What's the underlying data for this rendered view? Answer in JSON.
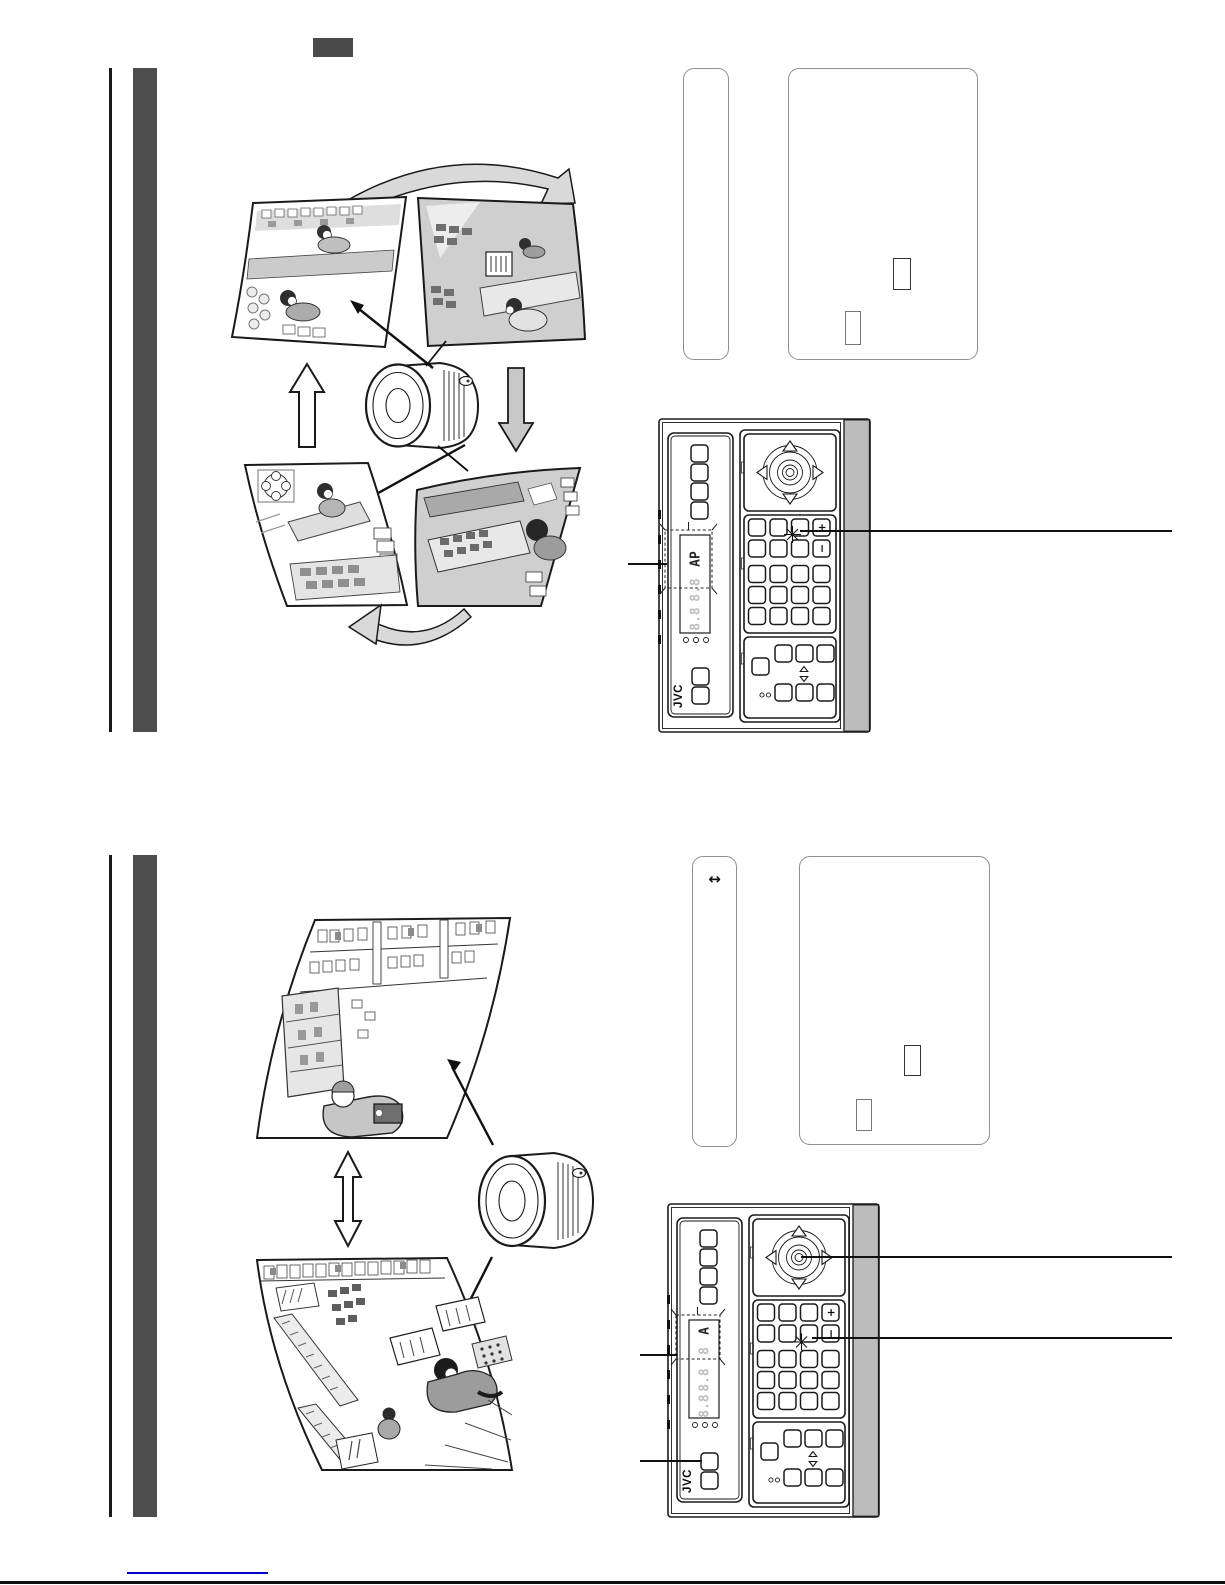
{
  "remote": {
    "brand": "JVC",
    "plus_key": "+",
    "minus_key": "−",
    "top_display": {
      "active": "AP",
      "ghost1": "8.8",
      "ghost2": "8.8"
    },
    "bottom_display": {
      "active": "A",
      "ghost0": "8",
      "ghost1": "8.8",
      "ghost2": "8.8"
    },
    "indicator_dot_count": 3
  },
  "annotations": {
    "horizontal_range_arrow": "↔"
  },
  "colors": {
    "section_bar": "#4d4d4d",
    "label_box": "#4a4a4a",
    "panel_side_strip": "#bcbcbc",
    "figure_band": "#d9d9d9",
    "link_underline": "#0000cc"
  }
}
